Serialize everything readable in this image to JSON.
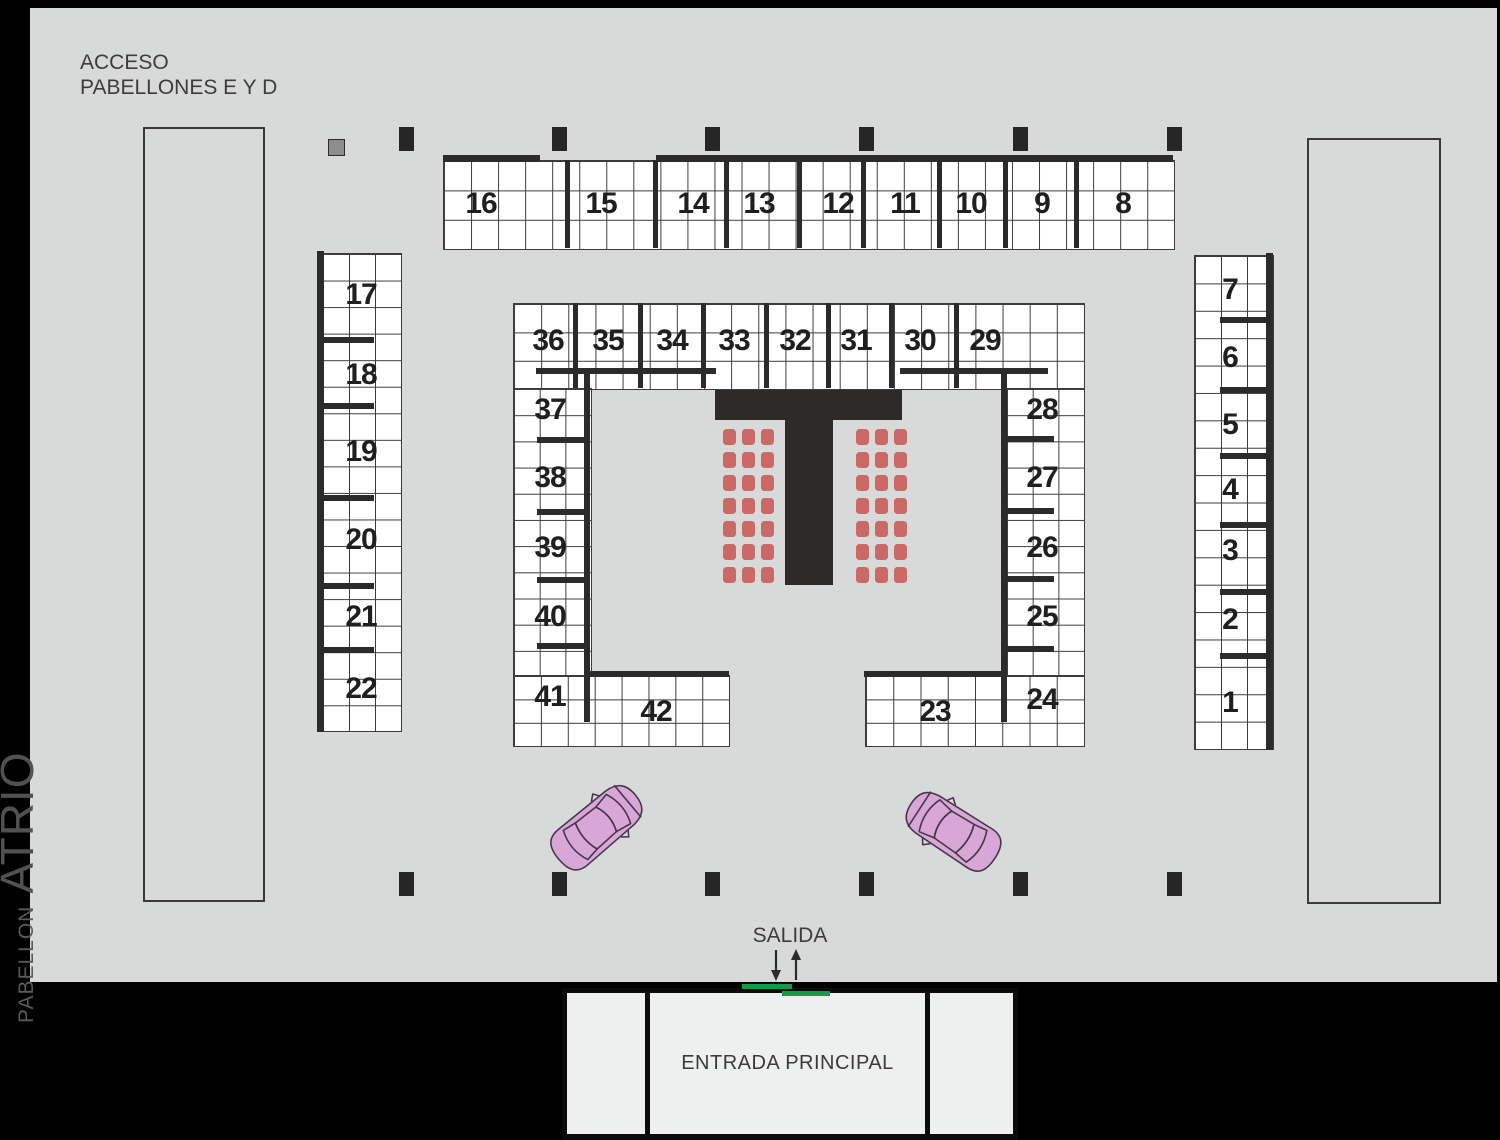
{
  "header": {
    "access_label_line1": "ACCESO",
    "access_label_line2": "PABELLONES E Y D"
  },
  "side_label": {
    "pavilion": "PABELLON",
    "hall_name": "ATRIO"
  },
  "exit": {
    "label": "SALIDA"
  },
  "entrance": {
    "label": "ENTRADA PRINCIPAL"
  },
  "booths": {
    "top_row": [
      "16",
      "15",
      "14",
      "13",
      "12",
      "11",
      "10",
      "9",
      "8"
    ],
    "left_column": [
      "17",
      "18",
      "19",
      "20",
      "21",
      "22"
    ],
    "right_column": [
      "7",
      "6",
      "5",
      "4",
      "3",
      "2",
      "1"
    ],
    "inner_top_row": [
      "36",
      "35",
      "34",
      "33",
      "32",
      "31",
      "30",
      "29"
    ],
    "inner_left_column": [
      "37",
      "38",
      "39",
      "40",
      "41"
    ],
    "inner_right_column": [
      "28",
      "27",
      "26",
      "25",
      "24"
    ],
    "inner_bottom": [
      "42",
      "23"
    ]
  },
  "colors": {
    "page_background": "#000000",
    "floor": "#d8dada",
    "booth_fill": "#ffffff",
    "grid_line": "#3c3c3c",
    "wall": "#2b2b2b",
    "stage_structure": "#2d2a27",
    "chair": "#cb6967",
    "car_body": "#d9a7d7",
    "door_marker": "#129c47",
    "service_box": "#8d8d8d"
  }
}
